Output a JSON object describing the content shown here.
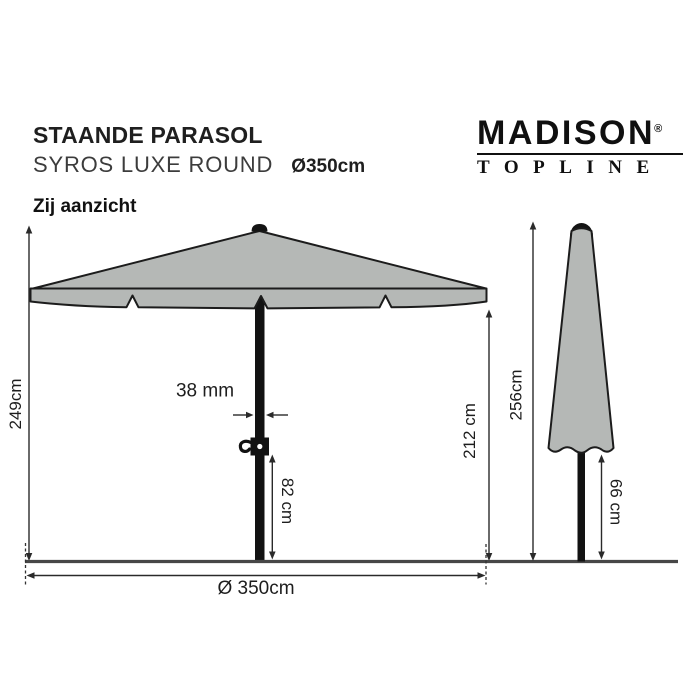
{
  "header": {
    "product_name": "STAANDE PARASOL",
    "product_variant": "SYROS LUXE ROUND",
    "diameter": "Ø350cm",
    "view_label": "Zij aanzicht"
  },
  "brand": {
    "name": "MADISON",
    "registered_mark": "®",
    "tagline": "TOPLINE"
  },
  "dimensions": {
    "open_total_height": "249cm",
    "pole_diameter": "38 mm",
    "open_clearance_height": "212 cm",
    "crank_height": "82 cm",
    "open_width": "Ø 350cm",
    "closed_total_height": "256cm",
    "closed_clearance_height": "66 cm"
  },
  "colors": {
    "canopy_fill": "#b5b8b6",
    "outline": "#1c1c1c",
    "dimension_lines": "#2a2a2a",
    "ground": "#474747",
    "background": "#ffffff"
  }
}
